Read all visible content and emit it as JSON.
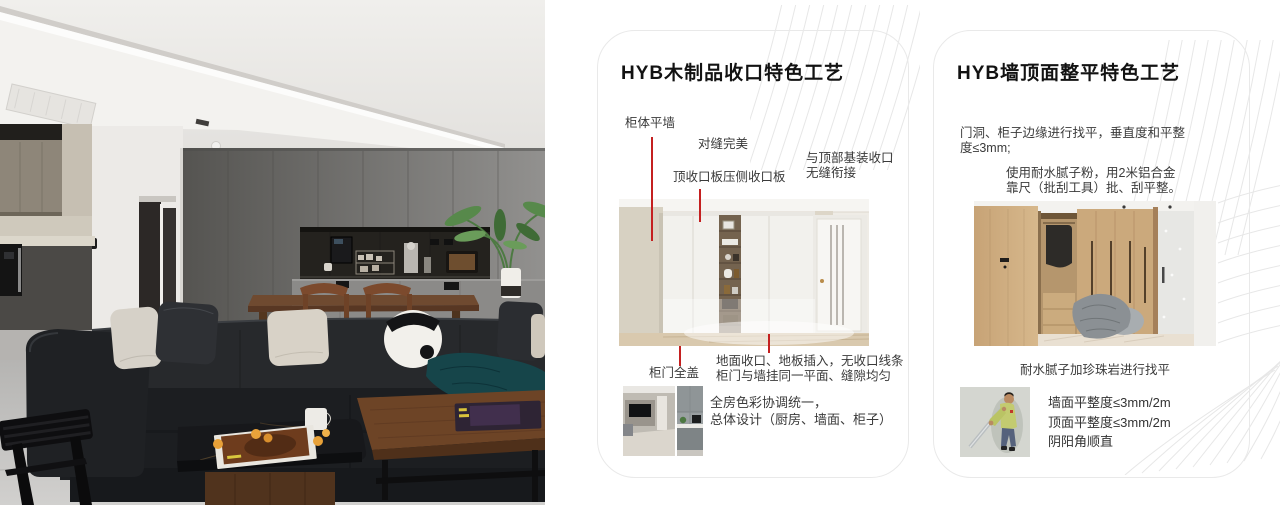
{
  "colors": {
    "annotation_red": "#c42020",
    "card_border": "#e9e9e9",
    "decor_line": "#e7e7e7",
    "page_background": "#ffffff"
  },
  "card1": {
    "title": "HYB木制品收口特色工艺",
    "ann_cabinet_wall": "柜体平墙",
    "ann_seam": "对缝完美",
    "ann_top_board": "顶收口板压侧收口板",
    "ann_ceiling_line1": "与顶部基装收口",
    "ann_ceiling_line2": "无缝衔接",
    "ann_door_cover": "柜门全盖",
    "ann_floor_line1": "地面收口、地板插入，无收口线条",
    "ann_floor_line2": "柜门与墙挂同一平面、缝隙均匀",
    "note_line1": "全房色彩协调统一，",
    "note_line2": "总体设计（厨房、墙面、柜子）"
  },
  "card2": {
    "title": "HYB墙顶面整平特色工艺",
    "para1_line1": "门洞、柜子边缘进行找平，垂直度和平整",
    "para1_line2": "度≤3mm;",
    "para2_line1": "使用耐水腻子粉，用2米铝合金",
    "para2_line2": "靠尺（批刮工具）批、刮平整。",
    "caption": "耐水腻子加珍珠岩进行找平",
    "metric_1": "墙面平整度≤3mm/2m",
    "metric_2": "顶面平整度≤3mm/2m",
    "metric_3": "阴阳角顺直"
  }
}
